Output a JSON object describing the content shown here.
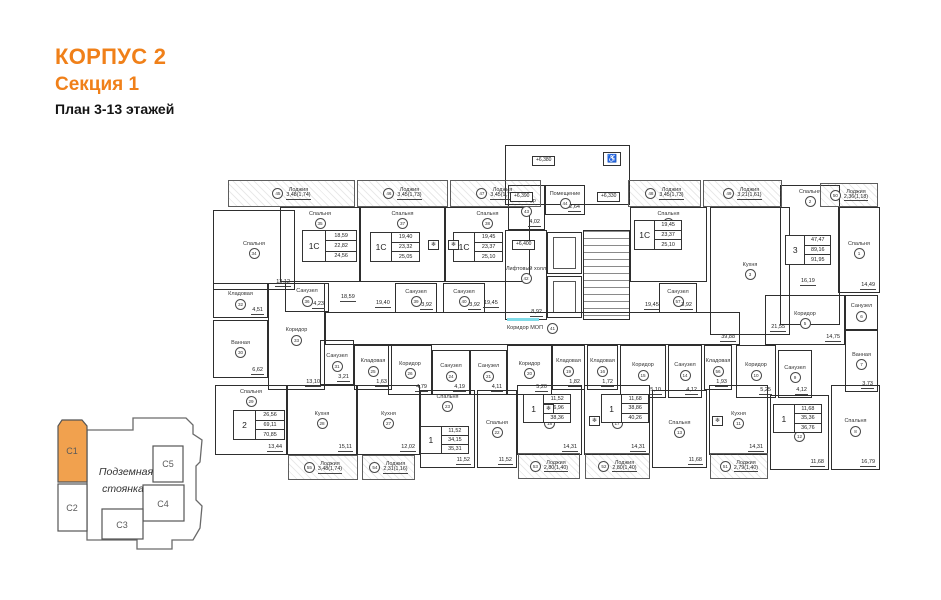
{
  "header": {
    "building": "КОРПУС 2",
    "section": "Секция 1",
    "plan_title": "План 3-13 этажей"
  },
  "colors": {
    "accent": "#F08019",
    "key_section_fill": "#F1A14E",
    "line": "#2e2e2e",
    "highlight": "#7FDBE8"
  },
  "key": {
    "label_line1": "Подземная",
    "label_line2": "стоянка",
    "sections": [
      {
        "id": "С1",
        "active": true
      },
      {
        "id": "С2",
        "active": false
      },
      {
        "id": "С3",
        "active": false
      },
      {
        "id": "С4",
        "active": false
      },
      {
        "id": "С5",
        "active": false
      }
    ]
  },
  "plan": {
    "loggia_label": "Лоджия",
    "loggias": [
      {
        "n": "45",
        "v": "3,48(1,74)",
        "x": 21,
        "y": 38,
        "w": 127,
        "h": 27
      },
      {
        "n": "46",
        "v": "3,45(1,73)",
        "x": 150,
        "y": 38,
        "w": 91,
        "h": 27
      },
      {
        "n": "47",
        "v": "3,45(1,73)",
        "x": 243,
        "y": 38,
        "w": 91,
        "h": 27
      },
      {
        "n": "48",
        "v": "3,45(1,73)",
        "x": 421,
        "y": 38,
        "w": 73,
        "h": 27
      },
      {
        "n": "49",
        "v": "3,21(1,61)",
        "x": 496,
        "y": 38,
        "w": 79,
        "h": 27
      },
      {
        "n": "50",
        "v": "2,36(1,18)",
        "x": 613,
        "y": 41,
        "w": 58,
        "h": 24
      },
      {
        "n": "55",
        "v": "3,48(1,74)",
        "x": 81,
        "y": 313,
        "w": 70,
        "h": 25
      },
      {
        "n": "54",
        "v": "2,31(1,16)",
        "x": 155,
        "y": 313,
        "w": 53,
        "h": 25
      },
      {
        "n": "53",
        "v": "2,80(1,40)",
        "x": 311,
        "y": 311,
        "w": 62,
        "h": 26
      },
      {
        "n": "52",
        "v": "2,80(1,40)",
        "x": 378,
        "y": 311,
        "w": 65,
        "h": 26
      },
      {
        "n": "51",
        "v": "2,79(1,40)",
        "x": 503,
        "y": 311,
        "w": 58,
        "h": 26
      }
    ],
    "rooms": [
      {
        "x": 298,
        "y": 3,
        "w": 125,
        "h": 60
      },
      {
        "n": "34",
        "l": "Спальня",
        "d": "13,12",
        "x": 6,
        "y": 68,
        "w": 82,
        "h": 80
      },
      {
        "n": "35",
        "l": "Спальня",
        "x": 73,
        "y": 65,
        "w": 80,
        "h": 75,
        "lt": 1
      },
      {
        "n": "37",
        "l": "Спальня",
        "x": 153,
        "y": 65,
        "w": 85,
        "h": 75,
        "lt": 1
      },
      {
        "n": "38",
        "l": "Спальня",
        "x": 238,
        "y": 65,
        "w": 85,
        "h": 75,
        "lt": 1
      },
      {
        "n": "4",
        "l": "Спальня",
        "x": 423,
        "y": 65,
        "w": 77,
        "h": 75,
        "lt": 1
      },
      {
        "n": "3",
        "l": "Кухня",
        "d": "21,55",
        "x": 503,
        "y": 65,
        "w": 80,
        "h": 128
      },
      {
        "n": "2",
        "l": "Спальня",
        "x": 573,
        "y": 43,
        "w": 60,
        "h": 140,
        "lt": 1
      },
      {
        "n": "1",
        "l": "Спальня",
        "d": "14,49",
        "x": 631,
        "y": 65,
        "w": 42,
        "h": 86
      },
      {
        "n": "32",
        "l": "Кладовая",
        "d": "4,51",
        "x": 6,
        "y": 141,
        "w": 55,
        "h": 35
      },
      {
        "n": "30",
        "l": "Ванная",
        "d": "6,62",
        "x": 6,
        "y": 178,
        "w": 55,
        "h": 58
      },
      {
        "n": "33",
        "l": "Коридор",
        "d": "13,10",
        "x": 61,
        "y": 141,
        "w": 57,
        "h": 107
      },
      {
        "n": "36",
        "l": "Санузел",
        "d": "4,23",
        "x": 78,
        "y": 141,
        "w": 44,
        "h": 29
      },
      {
        "n": "31",
        "l": "Санузел",
        "d": "3,21",
        "x": 113,
        "y": 198,
        "w": 34,
        "h": 45
      },
      {
        "n": "25",
        "l": "Кладовая",
        "d": "1,63",
        "x": 147,
        "y": 203,
        "w": 38,
        "h": 45
      },
      {
        "n": "39",
        "l": "Санузел",
        "d": "3,92",
        "x": 188,
        "y": 141,
        "w": 42,
        "h": 30
      },
      {
        "n": "40",
        "l": "Санузел",
        "d": "3,92",
        "x": 236,
        "y": 141,
        "w": 42,
        "h": 30
      },
      {
        "n": "57",
        "l": "Санузел",
        "d": "3,92",
        "x": 452,
        "y": 141,
        "w": 38,
        "h": 30
      },
      {
        "n": "43",
        "l": "Тамбур",
        "d": "4,02",
        "x": 301,
        "y": 43,
        "w": 37,
        "h": 45
      },
      {
        "n": "44",
        "l": "Помещение",
        "d": "2,64",
        "x": 338,
        "y": 43,
        "w": 40,
        "h": 30
      },
      {
        "n": "42",
        "l": "Лифтовый холл",
        "d": "8,92",
        "x": 298,
        "y": 88,
        "w": 42,
        "h": 90
      },
      {
        "n": "41",
        "l": "Коридор МОП",
        "d": "39,88",
        "x": 118,
        "y": 170,
        "w": 415,
        "h": 33,
        "wide": 1
      },
      {
        "n": "26",
        "l": "Коридор",
        "d": "4,79",
        "x": 181,
        "y": 203,
        "w": 44,
        "h": 50
      },
      {
        "n": "24",
        "l": "Санузел",
        "d": "4,19",
        "x": 225,
        "y": 208,
        "w": 38,
        "h": 45
      },
      {
        "n": "21",
        "l": "Санузел",
        "d": "4,11",
        "x": 263,
        "y": 208,
        "w": 37,
        "h": 45
      },
      {
        "n": "20",
        "l": "Коридор",
        "d": "5,20",
        "x": 300,
        "y": 203,
        "w": 45,
        "h": 50
      },
      {
        "n": "19",
        "l": "Кладовая",
        "d": "1,82",
        "x": 345,
        "y": 203,
        "w": 33,
        "h": 45
      },
      {
        "n": "16",
        "l": "Кладовая",
        "d": "1,72",
        "x": 380,
        "y": 203,
        "w": 31,
        "h": 45
      },
      {
        "n": "15",
        "l": "Коридор",
        "d": "5,10",
        "x": 413,
        "y": 203,
        "w": 46,
        "h": 53
      },
      {
        "n": "14",
        "l": "Санузел",
        "d": "4,12",
        "x": 461,
        "y": 203,
        "w": 34,
        "h": 53
      },
      {
        "n": "56",
        "l": "Кладовая",
        "d": "1,93",
        "x": 497,
        "y": 203,
        "w": 28,
        "h": 45
      },
      {
        "n": "10",
        "l": "Коридор",
        "d": "5,25",
        "x": 529,
        "y": 203,
        "w": 40,
        "h": 53
      },
      {
        "n": "9",
        "l": "Санузел",
        "d": "4,12",
        "x": 571,
        "y": 208,
        "w": 34,
        "h": 48
      },
      {
        "n": "5",
        "l": "Коридор",
        "d": "14,75",
        "x": 558,
        "y": 153,
        "w": 80,
        "h": 50
      },
      {
        "n": "7",
        "l": "Ванная",
        "d": "3,73",
        "x": 638,
        "y": 188,
        "w": 33,
        "h": 62
      },
      {
        "n": "6",
        "l": "Санузел",
        "x": 638,
        "y": 153,
        "w": 33,
        "h": 35
      },
      {
        "n": "29",
        "l": "Спальня",
        "d": "13,44",
        "x": 8,
        "y": 243,
        "w": 72,
        "h": 70,
        "lt": 1
      },
      {
        "n": "28",
        "l": "Кухня",
        "d": "15,11",
        "x": 80,
        "y": 243,
        "w": 70,
        "h": 70
      },
      {
        "n": "27",
        "l": "Кухня",
        "d": "12,02",
        "x": 150,
        "y": 243,
        "w": 63,
        "h": 70
      },
      {
        "n": "23",
        "l": "Спальня",
        "d": "11,52",
        "x": 213,
        "y": 248,
        "w": 55,
        "h": 78,
        "lt": 1
      },
      {
        "n": "22",
        "l": "Спальня",
        "d": "11,52",
        "x": 270,
        "y": 248,
        "w": 40,
        "h": 78
      },
      {
        "n": "18",
        "l": "Кухня",
        "d": "14,31",
        "x": 310,
        "y": 243,
        "w": 65,
        "h": 70
      },
      {
        "n": "17",
        "l": "Кухня",
        "d": "14,31",
        "x": 377,
        "y": 243,
        "w": 66,
        "h": 70
      },
      {
        "n": "13",
        "l": "Спальня",
        "d": "11,68",
        "x": 445,
        "y": 248,
        "w": 55,
        "h": 78
      },
      {
        "n": "11",
        "l": "Кухня",
        "d": "14,31",
        "x": 502,
        "y": 243,
        "w": 59,
        "h": 70
      },
      {
        "n": "12",
        "l": "Спальня",
        "d": "11,68",
        "x": 563,
        "y": 253,
        "w": 59,
        "h": 75
      },
      {
        "n": "8",
        "l": "Спальня",
        "d": "16,79",
        "x": 624,
        "y": 243,
        "w": 49,
        "h": 85
      }
    ],
    "tables": [
      {
        "t": "1С",
        "v": [
          "18,59",
          "22,82",
          "24,56"
        ],
        "x": 95,
        "y": 88,
        "w": 55,
        "h": 32
      },
      {
        "t": "1С",
        "v": [
          "19,40",
          "23,32",
          "25,05"
        ],
        "x": 163,
        "y": 90,
        "w": 50,
        "h": 30
      },
      {
        "t": "1С",
        "v": [
          "19,45",
          "23,37",
          "25,10"
        ],
        "x": 246,
        "y": 90,
        "w": 50,
        "h": 30
      },
      {
        "t": "1С",
        "v": [
          "19,45",
          "23,37",
          "25,10"
        ],
        "x": 427,
        "y": 78,
        "w": 48,
        "h": 30
      },
      {
        "t": "3",
        "v": [
          "47,47",
          "89,16",
          "91,95"
        ],
        "x": 578,
        "y": 93,
        "w": 46,
        "h": 30
      },
      {
        "t": "2",
        "v": [
          "26,56",
          "69,11",
          "70,85"
        ],
        "x": 26,
        "y": 268,
        "w": 52,
        "h": 30
      },
      {
        "t": "1",
        "v": [
          "11,52",
          "34,15",
          "35,31"
        ],
        "x": 213,
        "y": 284,
        "w": 49,
        "h": 28
      },
      {
        "t": "1",
        "v": [
          "11,52",
          "36,96",
          "38,36"
        ],
        "x": 316,
        "y": 252,
        "w": 48,
        "h": 29
      },
      {
        "t": "1",
        "v": [
          "11,68",
          "38,86",
          "40,26"
        ],
        "x": 394,
        "y": 252,
        "w": 48,
        "h": 29
      },
      {
        "t": "1",
        "v": [
          "11,68",
          "35,36",
          "36,76"
        ],
        "x": 566,
        "y": 262,
        "w": 49,
        "h": 29
      }
    ],
    "marks": [
      {
        "t": "+6,380",
        "x": 325,
        "y": 14
      },
      {
        "t": "+6,390",
        "x": 303,
        "y": 50
      },
      {
        "t": "+6,330",
        "x": 390,
        "y": 50
      },
      {
        "t": "+6,400",
        "x": 305,
        "y": 98
      }
    ],
    "dims": [
      {
        "t": "18,59",
        "x": 133,
        "y": 152
      },
      {
        "t": "19,40",
        "x": 168,
        "y": 158
      },
      {
        "t": "19,45",
        "x": 276,
        "y": 158
      },
      {
        "t": "19,45",
        "x": 437,
        "y": 160
      },
      {
        "t": "16,19",
        "x": 593,
        "y": 136
      }
    ],
    "icons": [
      {
        "name": "wheelchair-icon",
        "g": "♿",
        "x": 396,
        "y": 10,
        "boxed": 1
      },
      {
        "name": "refrigerator-icon",
        "g": "❄",
        "x": 221,
        "y": 98,
        "boxed": 1,
        "small": 1
      },
      {
        "name": "refrigerator-icon",
        "g": "❄",
        "x": 241,
        "y": 98,
        "boxed": 1,
        "small": 1
      },
      {
        "name": "refrigerator-icon",
        "g": "❄",
        "x": 336,
        "y": 262,
        "boxed": 1,
        "small": 1
      },
      {
        "name": "refrigerator-icon",
        "g": "❄",
        "x": 382,
        "y": 274,
        "boxed": 1,
        "small": 1
      },
      {
        "name": "refrigerator-icon",
        "g": "❄",
        "x": 505,
        "y": 274,
        "boxed": 1,
        "small": 1
      }
    ]
  }
}
